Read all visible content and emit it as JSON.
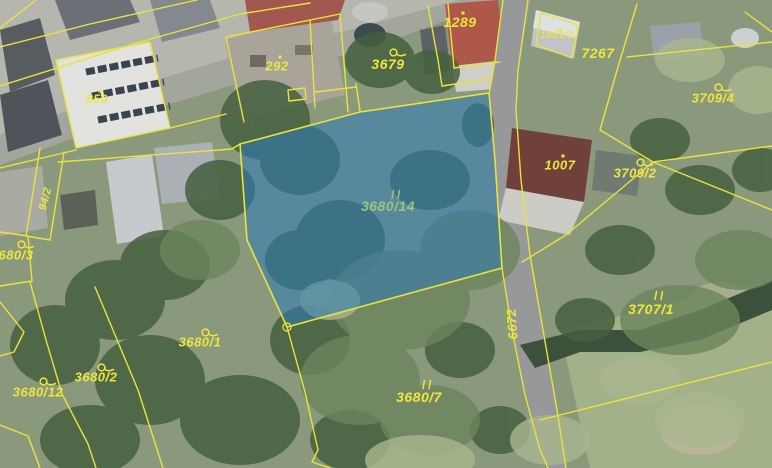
{
  "map": {
    "type": "cadastral-aerial-map",
    "highlighted_parcel": "3680/14",
    "colors": {
      "boundary_line": "#e9e33b",
      "label": "#ece63e",
      "highlight_fill": "#2e7ab8",
      "highlight_label": "#9cc47c",
      "road_surface": "#96989a"
    },
    "highlight_opacity": 0.55,
    "labels": [
      {
        "text": "850",
        "x": 97,
        "y": 99,
        "size": 12,
        "rot": 0,
        "symbol": "dot",
        "symbol_dy": -11
      },
      {
        "text": "94/2",
        "x": 46,
        "y": 199,
        "size": 11,
        "rot": -76,
        "symbol": "none"
      },
      {
        "text": "292",
        "x": 277,
        "y": 66,
        "size": 13,
        "rot": 0,
        "symbol": "dot",
        "symbol_dy": -12
      },
      {
        "text": "3679",
        "x": 388,
        "y": 64,
        "size": 14,
        "rot": 0,
        "symbol": "slucka",
        "symbol_dy": -17
      },
      {
        "text": "1289",
        "x": 460,
        "y": 22,
        "size": 14,
        "rot": 0,
        "symbol": "dot",
        "symbol_dy": -12
      },
      {
        "text": "1061/2",
        "x": 557,
        "y": 36,
        "size": 10,
        "rot": 0,
        "symbol": "dot",
        "symbol_dy": -9
      },
      {
        "text": "7267",
        "x": 598,
        "y": 53,
        "size": 14,
        "rot": 0,
        "symbol": "none"
      },
      {
        "text": "3709/4",
        "x": 713,
        "y": 98,
        "size": 13,
        "rot": 0,
        "symbol": "slucka",
        "symbol_dy": -16
      },
      {
        "text": "1007",
        "x": 560,
        "y": 165,
        "size": 13,
        "rot": 0,
        "symbol": "dot",
        "symbol_dy": -12
      },
      {
        "text": "3709/2",
        "x": 635,
        "y": 173,
        "size": 13,
        "rot": 0,
        "symbol": "slucka",
        "symbol_dy": -16
      },
      {
        "text": "3680/14",
        "x": 388,
        "y": 206,
        "size": 14,
        "rot": 0,
        "symbol": "ticks",
        "symbol_dy": -17,
        "color": "highlight"
      },
      {
        "text": "6672",
        "x": 512,
        "y": 324,
        "size": 13,
        "rot": -94,
        "symbol": "none"
      },
      {
        "text": "3707/1",
        "x": 651,
        "y": 309,
        "size": 14,
        "rot": 0,
        "symbol": "ticks",
        "symbol_dy": -19
      },
      {
        "text": "3680/1",
        "x": 200,
        "y": 342,
        "size": 13,
        "rot": 0,
        "symbol": "slucka",
        "symbol_dy": -15
      },
      {
        "text": "3680/2",
        "x": 96,
        "y": 377,
        "size": 13,
        "rot": 0,
        "symbol": "slucka",
        "symbol_dy": -15
      },
      {
        "text": "3680/12",
        "x": 38,
        "y": 392,
        "size": 13,
        "rot": 0,
        "symbol": "slucka",
        "symbol_dy": -16
      },
      {
        "text": "680/3",
        "x": 16,
        "y": 255,
        "size": 13,
        "rot": 0,
        "symbol": "slucka",
        "symbol_dy": -16
      },
      {
        "text": "3680/7",
        "x": 419,
        "y": 397,
        "size": 14,
        "rot": 0,
        "symbol": "ticks",
        "symbol_dy": -18
      }
    ]
  }
}
